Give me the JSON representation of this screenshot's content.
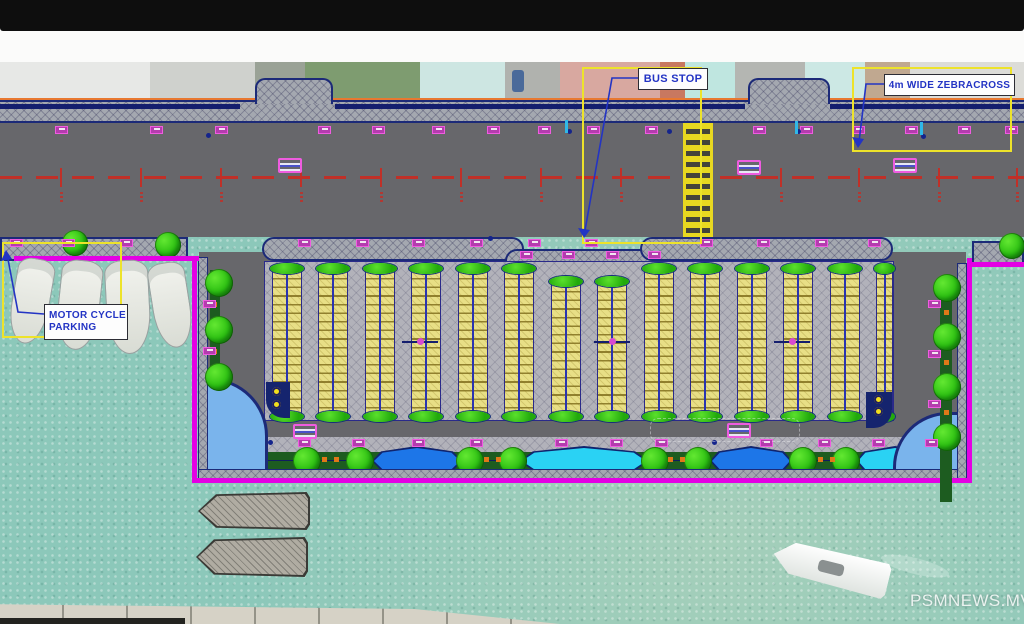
{
  "window": {
    "top_bar_color": "#0e0e0e",
    "white_strip_color": "#fbfbfa"
  },
  "watermark": {
    "text": "PSMNEWS.MV"
  },
  "annotations": {
    "bus_stop": {
      "label": "BUS STOP"
    },
    "zebracross": {
      "label": "4m WIDE ZEBRACROSS"
    },
    "motorcycle": {
      "label_line1": "MOTOR CYCLE",
      "label_line2": "PARKING"
    }
  },
  "colors": {
    "water": "#8cc8ba",
    "road": "#67676b",
    "boundary_magenta": "#e400e4",
    "stall_yellow": "#e8df86",
    "tree_green": "#2cc012",
    "planter_green": "#1d5c20",
    "plaza_blue": "#7ab4ec",
    "lens_dark_blue": "#1d76e8",
    "lens_cyan": "#2ad2f4",
    "highlight_yellow": "#ede32a",
    "label_blue": "#2334c4",
    "centerline_red": "#c03028",
    "zebra_yellow": "#e8d820",
    "orange_boundary": "#e87830",
    "marker_magenta": "#ef5ce0"
  },
  "plan": {
    "photo_strip": {
      "y": 0,
      "h": 38,
      "base": "#c2c6c2",
      "buildings": [
        {
          "x": 0,
          "w": 150,
          "c": "#e7e8e6"
        },
        {
          "x": 150,
          "w": 105,
          "c": "#cfd1cd"
        },
        {
          "x": 255,
          "w": 50,
          "c": "#9aa296"
        },
        {
          "x": 305,
          "w": 115,
          "c": "#7e9c70"
        },
        {
          "x": 420,
          "w": 85,
          "c": "#cde6e2"
        },
        {
          "x": 505,
          "w": 55,
          "c": "#b0b2ae"
        },
        {
          "x": 560,
          "w": 100,
          "c": "#d8a8a0"
        },
        {
          "x": 660,
          "w": 25,
          "c": "#c87860"
        },
        {
          "x": 685,
          "w": 50,
          "c": "#bfe6e0"
        },
        {
          "x": 735,
          "w": 70,
          "c": "#b4b6b2"
        },
        {
          "x": 805,
          "w": 60,
          "c": "#cce8e4"
        },
        {
          "x": 865,
          "w": 45,
          "c": "#c0a890"
        },
        {
          "x": 910,
          "w": 114,
          "c": "#dcdcd8"
        }
      ],
      "car": {
        "x": 512,
        "y": 8,
        "w": 12,
        "h": 22,
        "c": "#4a6a9a"
      }
    },
    "sidewalk_top": {
      "y": 38,
      "h": 23,
      "bumps": [
        {
          "x": 255,
          "w": 78
        },
        {
          "x": 748,
          "w": 82
        }
      ],
      "curb_segments": [
        {
          "x": 0,
          "w": 240
        },
        {
          "x": 335,
          "w": 410
        },
        {
          "x": 830,
          "w": 194
        }
      ]
    },
    "road_top": {
      "y": 61,
      "h": 114,
      "centerline_y": 114
    },
    "zebra": {
      "x": 683,
      "y": 61,
      "w": 30,
      "h": 117
    },
    "chainage_xs": [
      60,
      140,
      220,
      300,
      380,
      460,
      540,
      620,
      780,
      858,
      938,
      1016
    ],
    "tick_rows": [
      {
        "y": 64,
        "xs": [
          55,
          150,
          215,
          318,
          372,
          432,
          487,
          538,
          587,
          645,
          753,
          800,
          852,
          905,
          958,
          1005
        ]
      },
      {
        "y": 177,
        "xs": [
          10,
          62,
          120,
          298,
          356,
          412,
          470,
          528,
          585,
          700,
          757,
          815,
          868
        ]
      },
      {
        "y": 189,
        "xs": [
          520,
          562,
          606,
          648
        ]
      },
      {
        "y": 377,
        "xs": [
          298,
          352,
          412,
          470,
          555,
          610,
          655,
          760,
          818,
          872,
          925
        ]
      }
    ],
    "side_ticks": [
      {
        "x": 928,
        "y": 238
      },
      {
        "x": 928,
        "y": 288
      },
      {
        "x": 928,
        "y": 338
      },
      {
        "x": 203,
        "y": 238
      },
      {
        "x": 203,
        "y": 285
      }
    ],
    "humps": [
      {
        "x": 278,
        "y": 96
      },
      {
        "x": 737,
        "y": 98
      },
      {
        "x": 893,
        "y": 96
      },
      {
        "x": 293,
        "y": 362
      },
      {
        "x": 727,
        "y": 361
      }
    ],
    "blue_dots": [
      {
        "x": 206,
        "y": 71
      },
      {
        "x": 567,
        "y": 67
      },
      {
        "x": 667,
        "y": 67
      },
      {
        "x": 796,
        "y": 67
      },
      {
        "x": 921,
        "y": 72
      },
      {
        "x": 488,
        "y": 174
      },
      {
        "x": 268,
        "y": 378
      },
      {
        "x": 712,
        "y": 378
      }
    ],
    "cyan_dashes": [
      {
        "x": 565,
        "y": 58
      },
      {
        "x": 795,
        "y": 59
      },
      {
        "x": 920,
        "y": 60
      }
    ],
    "mid_band_segments": [
      {
        "x": 0,
        "y": 175,
        "w": 188,
        "h": 24,
        "r": "0"
      },
      {
        "x": 262,
        "y": 175,
        "w": 262,
        "h": 24,
        "r": "12px"
      },
      {
        "x": 505,
        "y": 187,
        "w": 150,
        "h": 24,
        "r": "12px"
      },
      {
        "x": 640,
        "y": 175,
        "w": 253,
        "h": 24,
        "r": "12px"
      },
      {
        "x": 972,
        "y": 179,
        "w": 52,
        "h": 24,
        "r": "0"
      }
    ],
    "peninsula": {
      "x": 199,
      "y": 190,
      "w": 767,
      "h": 227
    },
    "field": {
      "x": 265,
      "y": 200,
      "w": 628,
      "h": 158
    },
    "bands": [
      {
        "x": 272,
        "y": 208
      },
      {
        "x": 318,
        "y": 208
      },
      {
        "x": 365,
        "y": 208
      },
      {
        "x": 411,
        "y": 208
      },
      {
        "x": 458,
        "y": 208
      },
      {
        "x": 504,
        "y": 208
      },
      {
        "x": 551,
        "y": 221
      },
      {
        "x": 597,
        "y": 221
      },
      {
        "x": 644,
        "y": 208
      },
      {
        "x": 690,
        "y": 208
      },
      {
        "x": 737,
        "y": 208
      },
      {
        "x": 783,
        "y": 208
      },
      {
        "x": 830,
        "y": 208
      },
      {
        "x": 876,
        "y": 208,
        "w": 17
      }
    ],
    "band_w": 30,
    "band_bottom": 353,
    "aisle_markers": [
      {
        "x": 420,
        "y": 279
      },
      {
        "x": 612,
        "y": 279
      },
      {
        "x": 792,
        "y": 279
      }
    ],
    "corner_blocks": [
      {
        "x": 266,
        "y": 320,
        "w": 24,
        "h": 36,
        "corner": "bl",
        "lights": [
          [
            276,
            329
          ],
          [
            276,
            342
          ]
        ]
      },
      {
        "x": 866,
        "y": 330,
        "w": 26,
        "h": 36,
        "corner": "br",
        "lights": [
          [
            878,
            337
          ],
          [
            878,
            349
          ]
        ]
      }
    ],
    "extra_lights": [
      [
        940,
        402
      ],
      [
        940,
        414
      ]
    ],
    "plazas": [
      {
        "x": 203,
        "y": 316,
        "w": 65,
        "h": 101,
        "round": "tr"
      },
      {
        "x": 893,
        "y": 350,
        "w": 67,
        "h": 67,
        "round": "tl"
      }
    ],
    "promenade": {
      "walk": {
        "x": 268,
        "y": 375,
        "w": 672,
        "h": 15
      },
      "planter": {
        "x": 268,
        "y": 390,
        "w": 672,
        "h": 18
      }
    },
    "lenses": [
      {
        "x": 372,
        "y": 384,
        "w": 90,
        "h": 30,
        "c": "#1d76e8"
      },
      {
        "x": 520,
        "y": 384,
        "w": 128,
        "h": 30,
        "c": "#2ad2f4"
      },
      {
        "x": 710,
        "y": 384,
        "w": 82,
        "h": 30,
        "c": "#1d76e8"
      },
      {
        "x": 856,
        "y": 384,
        "w": 78,
        "h": 30,
        "c": "#2ad2f4"
      }
    ],
    "trees_bottom_xs": [
      307,
      360,
      470,
      513,
      655,
      698,
      803,
      846
    ],
    "trees_upper": [
      {
        "x": 62,
        "y": 168
      },
      {
        "x": 155,
        "y": 170
      },
      {
        "x": 999,
        "y": 171
      }
    ],
    "left_planter": {
      "x": 210,
      "y": 208,
      "w": 10,
      "h": 115,
      "trees": [
        [
          205,
          207
        ],
        [
          205,
          254
        ],
        [
          205,
          301
        ]
      ],
      "dots": [
        [
          212,
          240
        ],
        [
          212,
          287
        ]
      ]
    },
    "right_planter": {
      "x": 940,
      "y": 215,
      "w": 12,
      "h": 225,
      "trees": [
        [
          933,
          212
        ],
        [
          933,
          261
        ],
        [
          933,
          311
        ],
        [
          933,
          361
        ]
      ],
      "dots": [
        [
          944,
          248
        ],
        [
          944,
          298
        ],
        [
          944,
          348
        ]
      ]
    },
    "orange_dots": [
      [
        322,
        395
      ],
      [
        334,
        395
      ],
      [
        484,
        395
      ],
      [
        496,
        395
      ],
      [
        668,
        395
      ],
      [
        680,
        395
      ],
      [
        818,
        395
      ],
      [
        830,
        395
      ]
    ],
    "boundary": {
      "stub_left": {
        "x": 14,
        "y": 194,
        "w": 185,
        "h": 5
      },
      "u": {
        "x": 192,
        "y": 196,
        "w": 780,
        "h": 225
      },
      "stub_right": {
        "x": 967,
        "y": 200,
        "w": 57,
        "h": 5
      }
    },
    "inner_hatch": [
      {
        "x": 199,
        "y": 196,
        "w": 8,
        "h": 220
      },
      {
        "x": 199,
        "y": 408,
        "w": 758,
        "h": 9
      },
      {
        "x": 958,
        "y": 202,
        "w": 8,
        "h": 215
      }
    ],
    "bus_bay_dash": {
      "x": 650,
      "y": 356,
      "w": 150,
      "h": 24
    },
    "moored_boats": [
      {
        "x": 12,
        "y": 196,
        "w": 36,
        "h": 84,
        "rot": 10
      },
      {
        "x": 58,
        "y": 198,
        "w": 40,
        "h": 88,
        "rot": 6
      },
      {
        "x": 106,
        "y": 198,
        "w": 42,
        "h": 92,
        "rot": -3
      },
      {
        "x": 152,
        "y": 200,
        "w": 36,
        "h": 84,
        "rot": -9
      }
    ],
    "hatched_boats": [
      {
        "x": 198,
        "y": 430,
        "w": 112,
        "h": 38
      },
      {
        "x": 196,
        "y": 475,
        "w": 112,
        "h": 40
      }
    ],
    "white_boat": {
      "x": 772,
      "y": 488,
      "w": 118,
      "h": 36,
      "rot": 14
    },
    "quay": {
      "x": 0,
      "y": 540,
      "w": 560,
      "h": 22
    },
    "dark_edge": {
      "x": 0,
      "y": 556,
      "w": 185,
      "h": 6
    },
    "highlight_boxes": {
      "bus": {
        "x": 582,
        "y": 5,
        "w": 120,
        "h": 177
      },
      "zebra": {
        "x": 852,
        "y": 5,
        "w": 160,
        "h": 85
      },
      "moto": {
        "x": 2,
        "y": 180,
        "w": 120,
        "h": 96
      }
    },
    "leaders": [
      {
        "pts": "638,16 612,16 584,174",
        "arrow": [
          584,
          176,
          578,
          166,
          590,
          168
        ]
      },
      {
        "pts": "884,22 866,22 859,80",
        "arrow": [
          858,
          86,
          852,
          75,
          864,
          77
        ]
      },
      {
        "pts": "44,252 18,250 7,192",
        "arrow": [
          6,
          188,
          1,
          199,
          12,
          197
        ]
      }
    ],
    "labels": {
      "bus": {
        "x": 638,
        "y": 6,
        "w": 68,
        "h": 20,
        "fs": 11
      },
      "zebra": {
        "x": 884,
        "y": 12,
        "w": 129,
        "h": 20,
        "fs": 10
      },
      "moto": {
        "x": 44,
        "y": 242,
        "w": 78,
        "h": 34,
        "fs": 10
      }
    },
    "watermark_pos": {
      "x": 910,
      "y": 529
    }
  }
}
